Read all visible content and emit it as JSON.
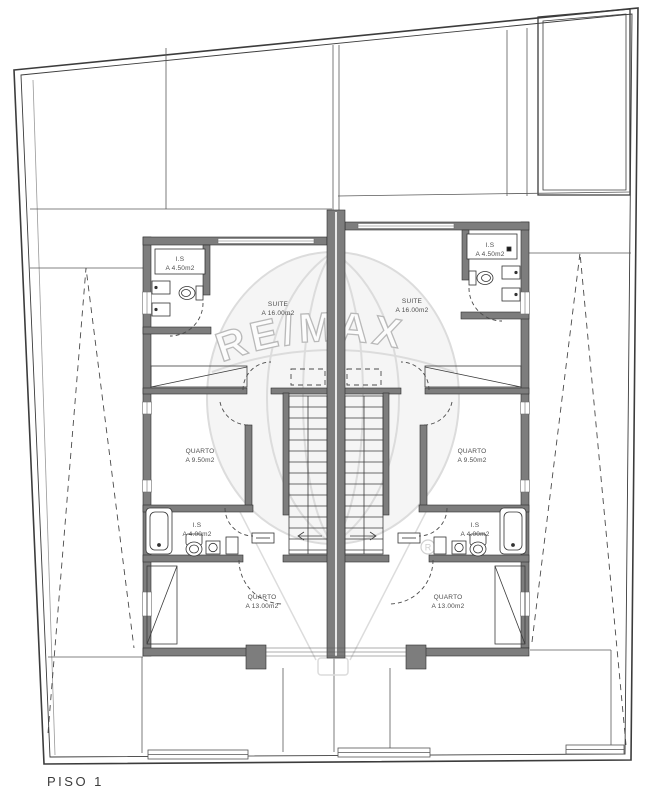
{
  "floor_label": "PISO 1",
  "watermark": {
    "brand": "RE/MAX",
    "registered_mark": "R"
  },
  "units": {
    "left": {
      "rooms": [
        {
          "name": "I.S",
          "area": "A 4.50m2"
        },
        {
          "name": "SUITE",
          "area": "A 16.00m2"
        },
        {
          "name": "QUARTO",
          "area": "A 9.50m2"
        },
        {
          "name": "I.S",
          "area": "A 4.00m2"
        },
        {
          "name": "QUARTO",
          "area": "A 13.00m2"
        }
      ]
    },
    "right": {
      "rooms": [
        {
          "name": "I.S",
          "area": "A 4.50m2"
        },
        {
          "name": "SUITE",
          "area": "A 16.00m2"
        },
        {
          "name": "QUARTO",
          "area": "A 9.50m2"
        },
        {
          "name": "I.S",
          "area": "A 4.00m2"
        },
        {
          "name": "QUARTO",
          "area": "A 13.00m2"
        }
      ]
    }
  },
  "colors": {
    "wall": "#7d7d7d",
    "line": "#3c3c3c",
    "watermark": "#d9d9d9",
    "background": "#ffffff"
  }
}
